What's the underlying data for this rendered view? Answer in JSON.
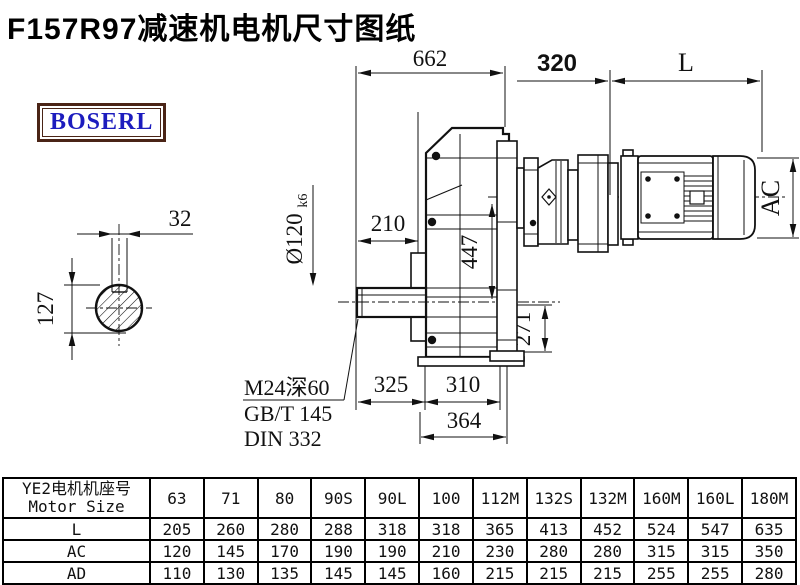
{
  "title": "F157R97减速机电机尺寸图纸",
  "logo": {
    "text": "BOSERL",
    "text_color": "#1c1cbe",
    "border_color": "#4a2416"
  },
  "drawing": {
    "dims": {
      "overall_width": "662",
      "adapter_length": "320",
      "motor_length": "L",
      "key_width": "32",
      "shaft_section_height": "127",
      "shaft_diameter": "Ø120",
      "shaft_diameter_tolerance": "k6",
      "bore_to_face": "210",
      "housing_height": "447",
      "flange_bottom_height": "271",
      "foot_spacing_left": "325",
      "foot_spacing_right": "310",
      "base_width": "364",
      "motor_height": "AC",
      "tap_hole": "M24深60",
      "tap_standard_gb": "GB/T 145",
      "tap_standard_din": "DIN 332"
    }
  },
  "table": {
    "row_header_cn": "YE2电机机座号",
    "row_header_en": "Motor Size",
    "sizes": [
      "63",
      "71",
      "80",
      "90S",
      "90L",
      "100",
      "112M",
      "132S",
      "132M",
      "160M",
      "160L",
      "180M"
    ],
    "rows": [
      {
        "label": "L",
        "values": [
          "205",
          "260",
          "280",
          "288",
          "318",
          "318",
          "365",
          "413",
          "452",
          "524",
          "547",
          "635"
        ]
      },
      {
        "label": "AC",
        "values": [
          "120",
          "145",
          "170",
          "190",
          "190",
          "210",
          "230",
          "280",
          "280",
          "315",
          "315",
          "350"
        ]
      },
      {
        "label": "AD",
        "values": [
          "110",
          "130",
          "135",
          "145",
          "145",
          "160",
          "215",
          "215",
          "215",
          "255",
          "255",
          "280"
        ]
      }
    ]
  }
}
